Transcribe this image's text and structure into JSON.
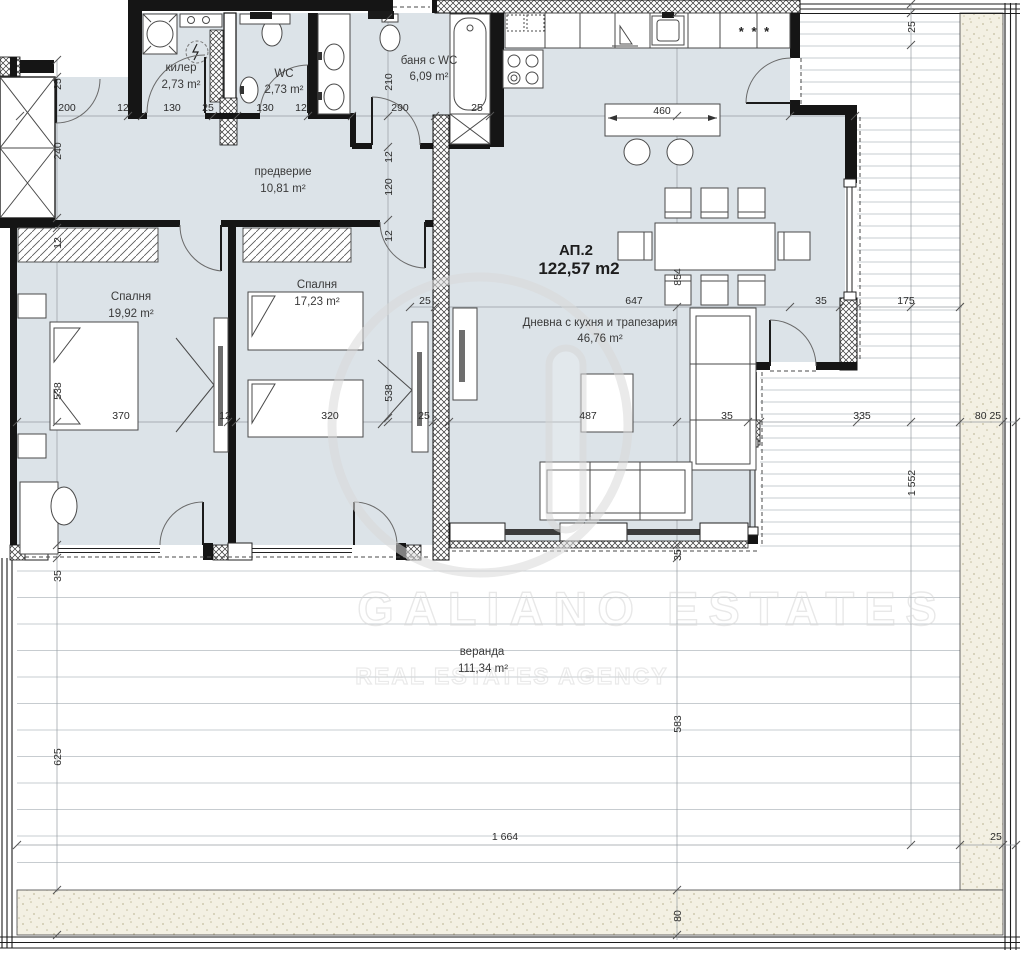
{
  "unit": {
    "code": "АП.2",
    "area": "122,57 m2"
  },
  "rooms": {
    "storage": {
      "name": "килер",
      "area": "2,73 m²"
    },
    "wc": {
      "name": "WC",
      "area": "2,73 m²"
    },
    "bathroom": {
      "name": "баня с WC",
      "area": "6,09 m²"
    },
    "hallway": {
      "name": "предверие",
      "area": "10,81 m²"
    },
    "bedroom1": {
      "name": "Спалня",
      "area": "19,92 m²"
    },
    "bedroom2": {
      "name": "Спалня",
      "area": "17,23 m²"
    },
    "living": {
      "name": "Дневна с кухня и трапезария",
      "area": "46,76 m²"
    },
    "veranda": {
      "name": "веранда",
      "area": "111,34 m²"
    }
  },
  "dims": {
    "top": [
      "200",
      "12",
      "130",
      "25",
      "130",
      "12",
      "290",
      "25",
      "460"
    ],
    "mid": [
      "25",
      "647",
      "35",
      "175"
    ],
    "main": [
      "370",
      "12",
      "320",
      "25",
      "487",
      "35",
      "335",
      "80 25"
    ],
    "bottom": [
      "1 664",
      "25"
    ],
    "vleft": [
      "25",
      "240",
      "12",
      "538",
      "35",
      "625"
    ],
    "vbath": [
      "210",
      "12",
      "120",
      "12",
      "538"
    ],
    "vmid": [
      "854",
      "35",
      "583",
      "80"
    ],
    "vright": [
      "25",
      "1 552"
    ]
  },
  "kitchen": {
    "freezer_label": "* * *"
  },
  "watermark": {
    "brand": "GALIANO  ESTATES",
    "tagline": "REAL ESTATES AGENCY",
    "logo_glyph": ""
  },
  "colors": {
    "floor": "#dce3e8",
    "wall": "#151515",
    "deck_line": "#c7ccd0",
    "stipple_bg": "#f3f0e3",
    "dim_text": "#2b2b2b",
    "watermark": "#d7d7d7"
  }
}
